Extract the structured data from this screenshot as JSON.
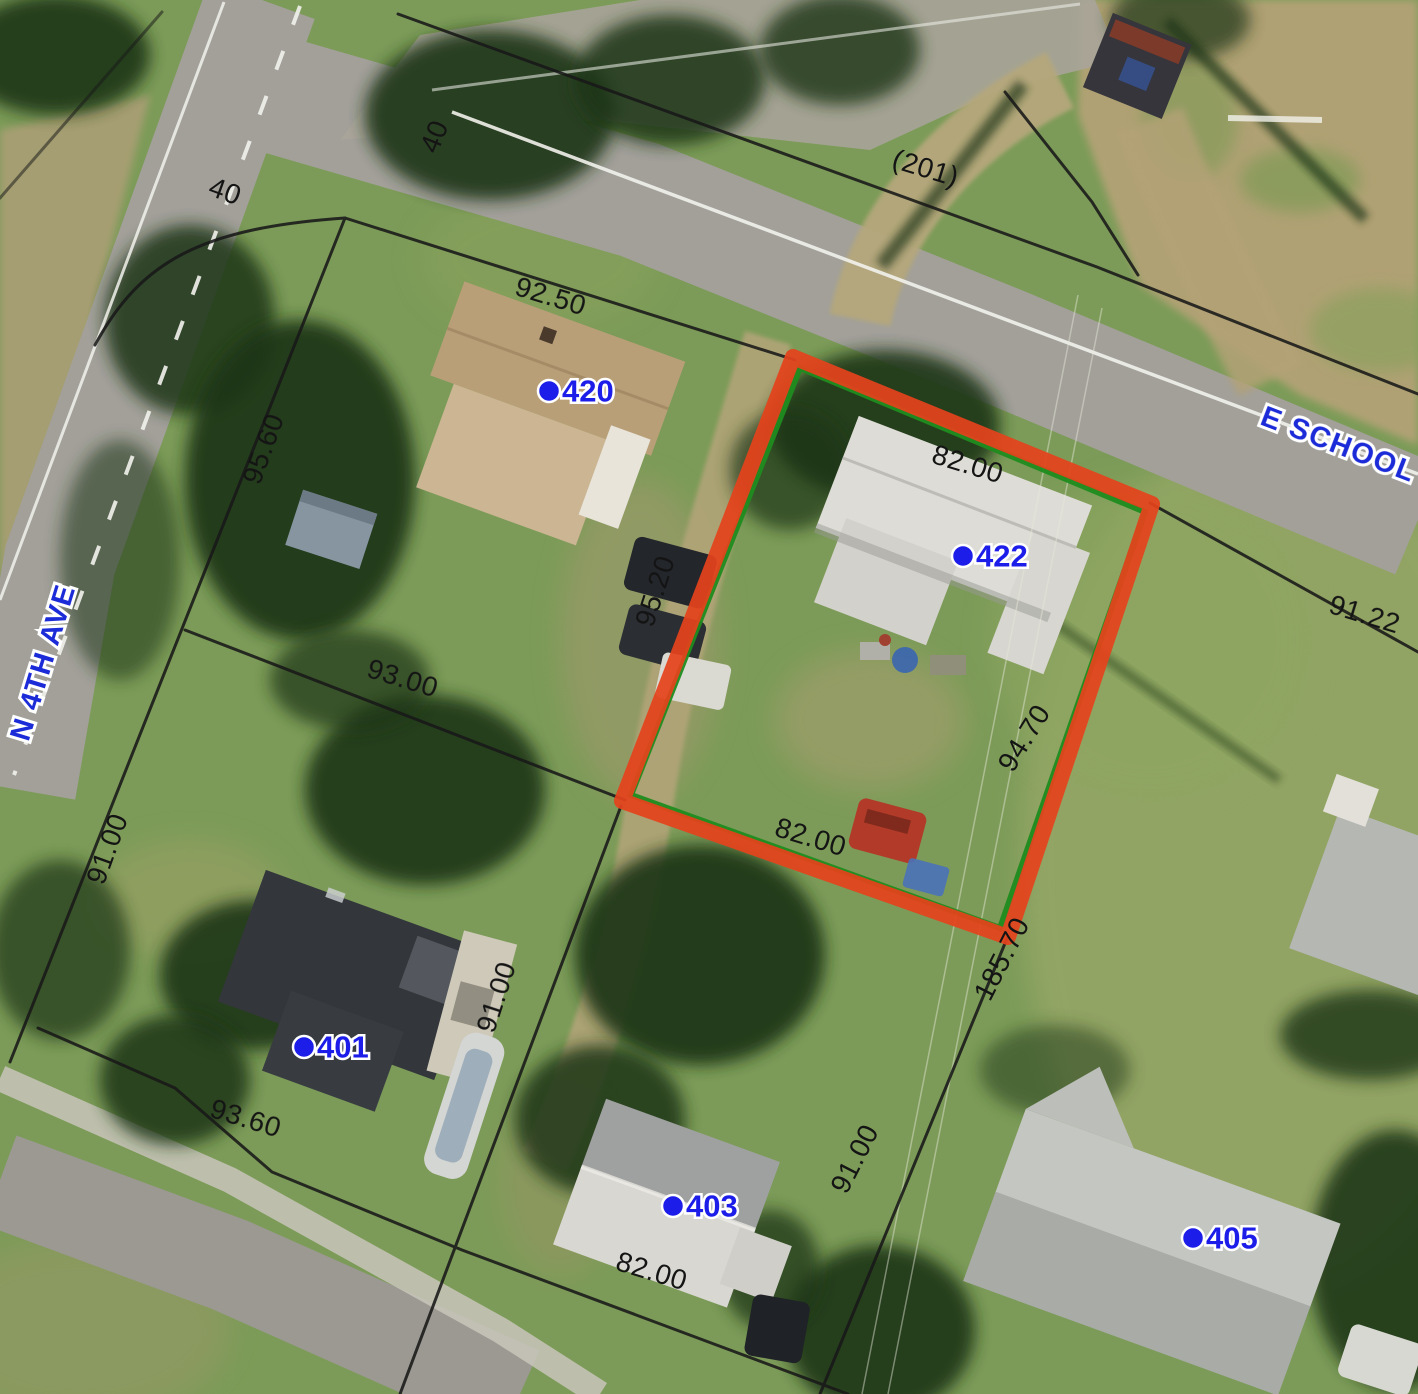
{
  "map": {
    "street_labels": [
      {
        "text": "N 4TH AVE"
      },
      {
        "text": "E SCHOOL ST"
      }
    ],
    "parcel_labels": [
      {
        "text": "420"
      },
      {
        "text": "422"
      },
      {
        "text": "401"
      },
      {
        "text": "403"
      },
      {
        "text": "405"
      }
    ],
    "dimension_labels": [
      {
        "text": "40"
      },
      {
        "text": "40"
      },
      {
        "text": "(201)"
      },
      {
        "text": "92.50"
      },
      {
        "text": "95.60"
      },
      {
        "text": "82.00"
      },
      {
        "text": "91.22"
      },
      {
        "text": "95.20"
      },
      {
        "text": "93.00"
      },
      {
        "text": "94.70"
      },
      {
        "text": "91.00"
      },
      {
        "text": "82.00"
      },
      {
        "text": "185.70"
      },
      {
        "text": "91.00"
      },
      {
        "text": "93.60"
      },
      {
        "text": "91.00"
      },
      {
        "text": "82.00"
      }
    ],
    "highlighted_parcel": {
      "number": "422",
      "outline_color": "#e4431c",
      "boundary_color": "#1f8c1f"
    },
    "colors": {
      "parcel_line": "#191919",
      "label_blue": "#1d1dea",
      "dimension_black": "#141414"
    }
  }
}
